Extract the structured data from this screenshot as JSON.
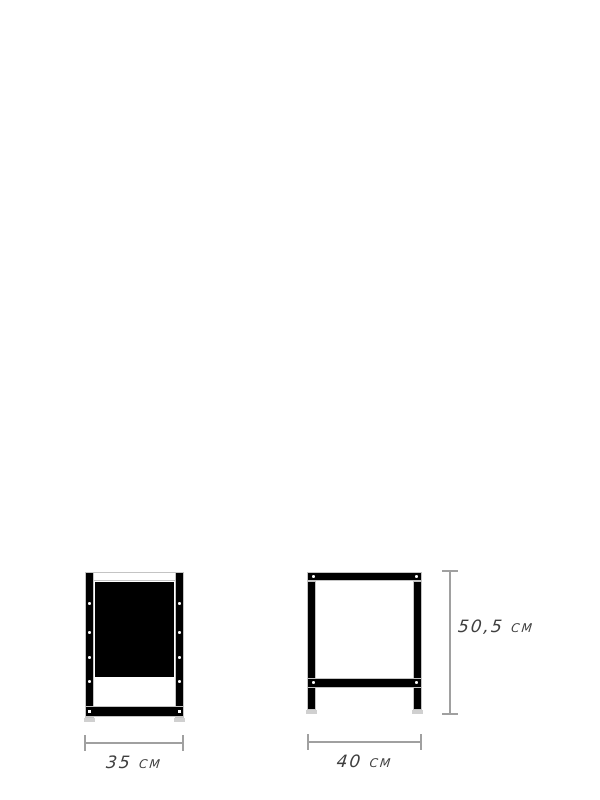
{
  "labels": {
    "front_width": "35 cm",
    "side_width": "40 cm",
    "side_height": "50,5 cm"
  },
  "colors": {
    "ink": "#000000",
    "frame_outline": "#c4c4c4",
    "foot": "#d0d0d0",
    "dimension_line": "#a0a0a0",
    "label_text": "#3f3f3f",
    "background": "#ffffff"
  }
}
